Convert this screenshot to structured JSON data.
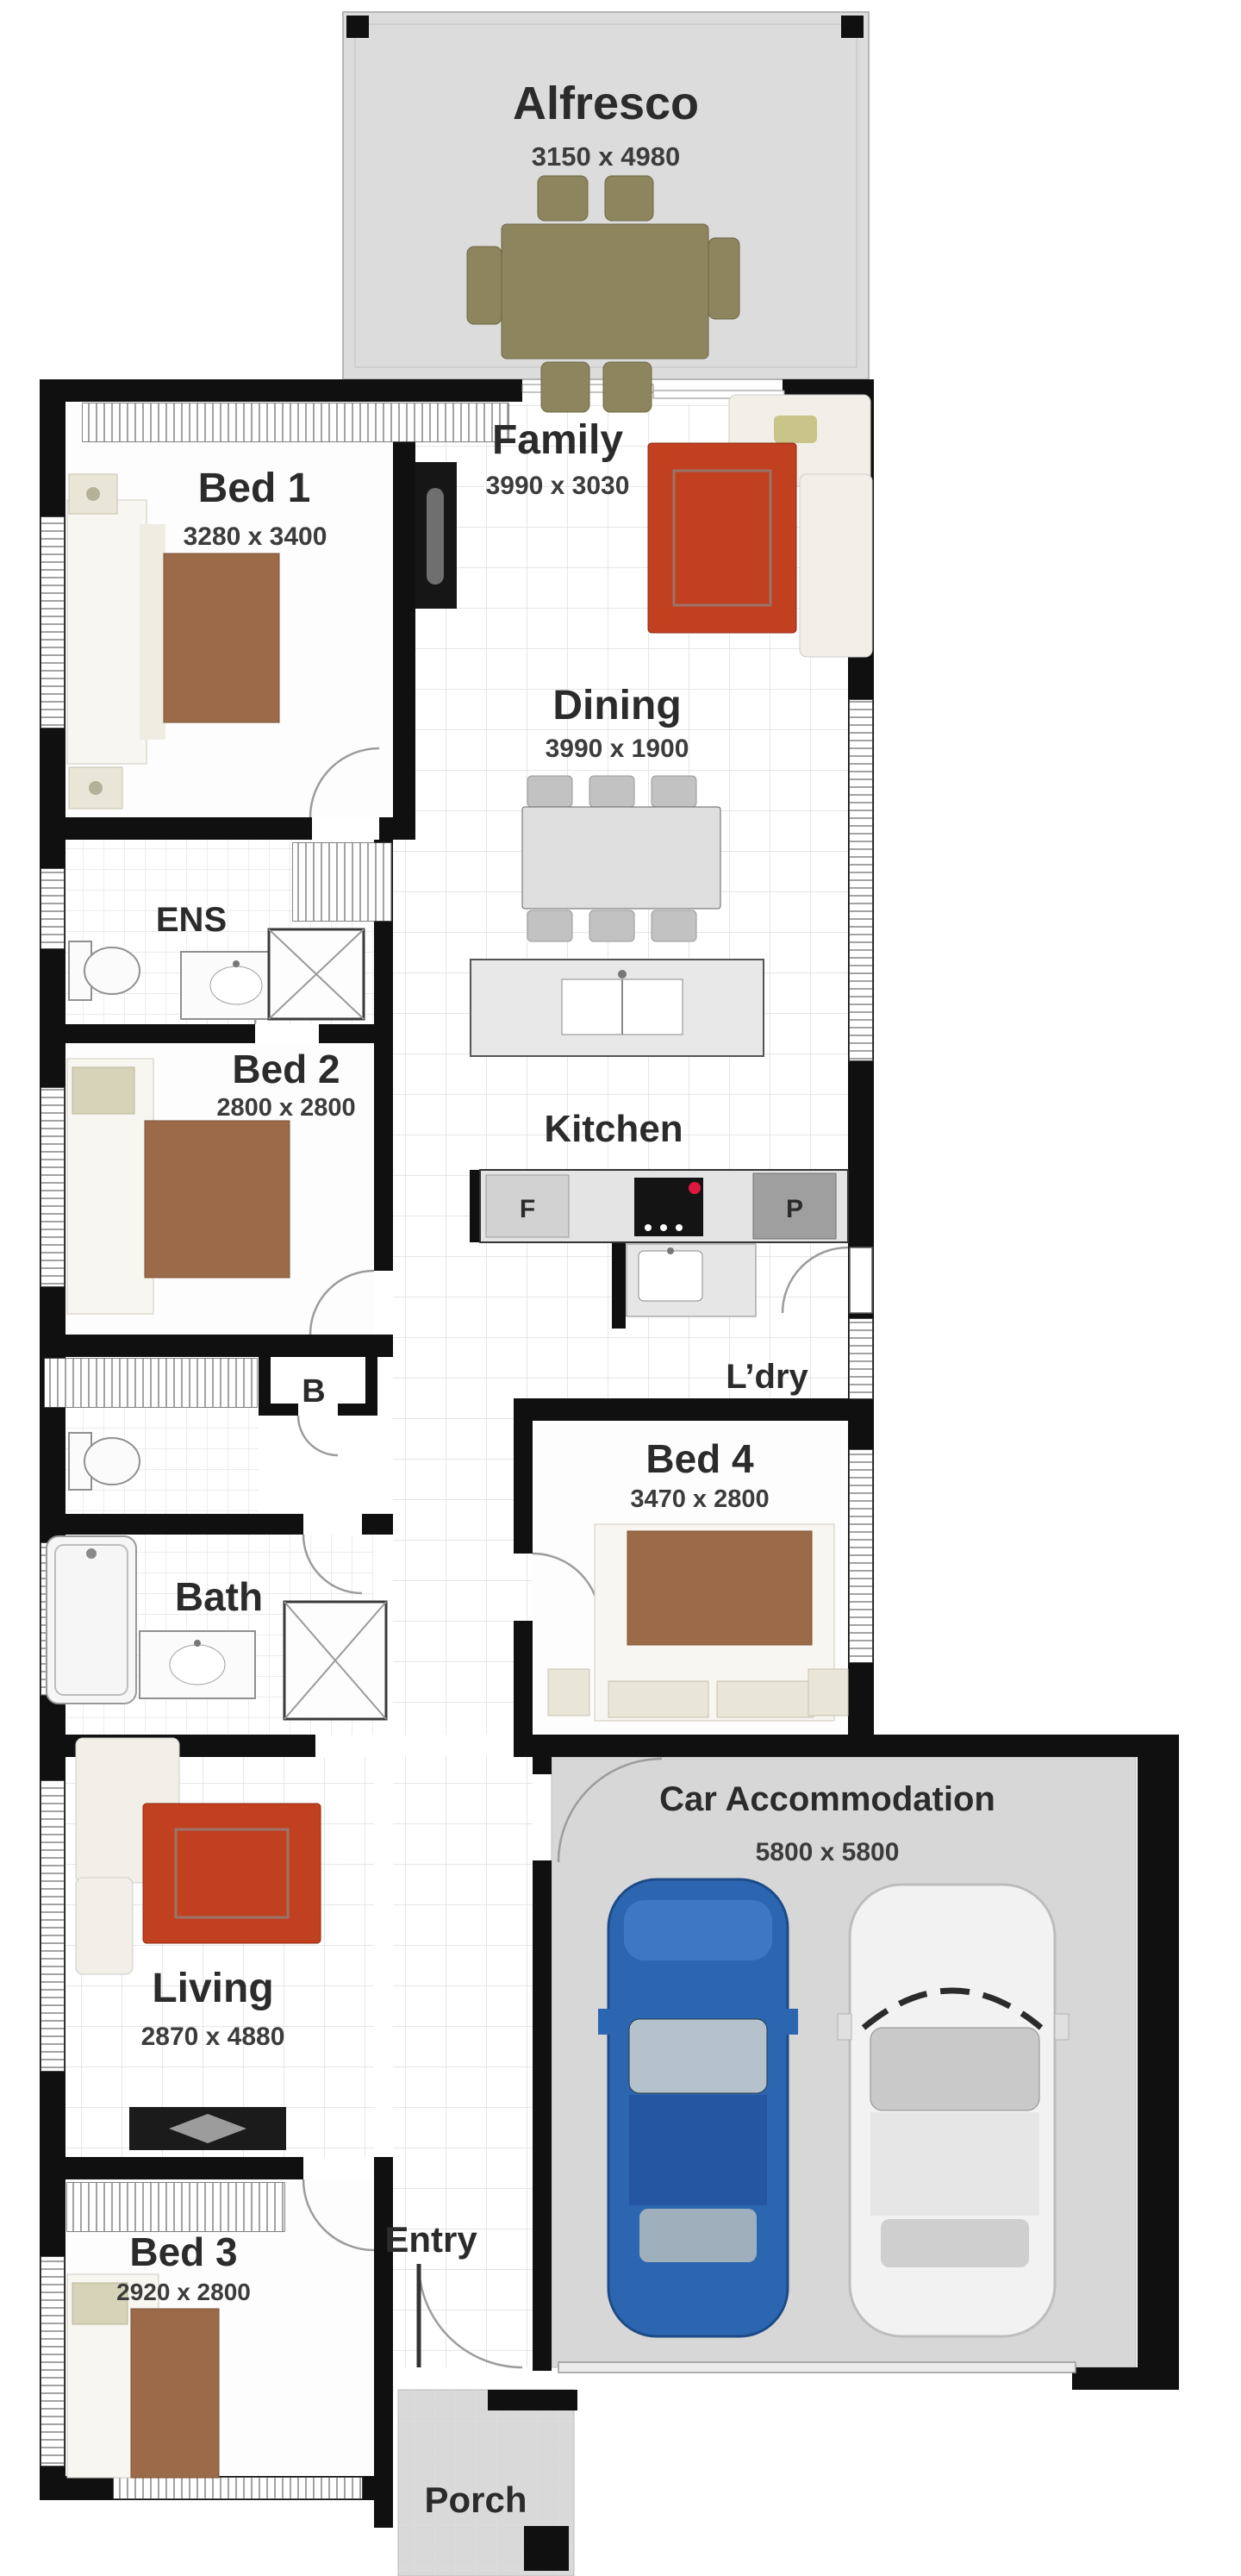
{
  "plan": {
    "rooms": [
      {
        "id": "alfresco",
        "label": "Alfresco",
        "dims": "3150 x 4980"
      },
      {
        "id": "bed1",
        "label": "Bed 1",
        "dims": "3280 x 3400"
      },
      {
        "id": "family",
        "label": "Family",
        "dims": "3990 x 3030"
      },
      {
        "id": "dining",
        "label": "Dining",
        "dims": "3990 x 1900"
      },
      {
        "id": "ens",
        "label": "ENS"
      },
      {
        "id": "bed2",
        "label": "Bed 2",
        "dims": "2800 x 2800"
      },
      {
        "id": "kitchen",
        "label": "Kitchen"
      },
      {
        "id": "ldry",
        "label": "L’dry"
      },
      {
        "id": "b",
        "label": "B"
      },
      {
        "id": "bed4",
        "label": "Bed 4",
        "dims": "3470 x 2800"
      },
      {
        "id": "bath",
        "label": "Bath"
      },
      {
        "id": "living",
        "label": "Living",
        "dims": "2870 x 4880"
      },
      {
        "id": "car",
        "label": "Car Accommodation",
        "dims": "5800 x 5800"
      },
      {
        "id": "bed3",
        "label": "Bed 3",
        "dims": "2920 x 2800"
      },
      {
        "id": "entry",
        "label": "Entry"
      },
      {
        "id": "porch",
        "label": "Porch"
      }
    ],
    "kitchen_markers": {
      "fridge": "F",
      "pantry": "P"
    }
  },
  "colors": {
    "wall": "#101010",
    "quilt": "#9b6b49",
    "sofa_red": "#c04020",
    "car_blue": "#2d66b0",
    "car_white": "#f2f2f2",
    "outdoor_furniture": "#8c855e",
    "alfresco_floor": "#dcdcdc",
    "garage_floor": "#d7d7d7",
    "porch_floor": "#d9d9d9",
    "label_ink": "#2b2b2b"
  }
}
